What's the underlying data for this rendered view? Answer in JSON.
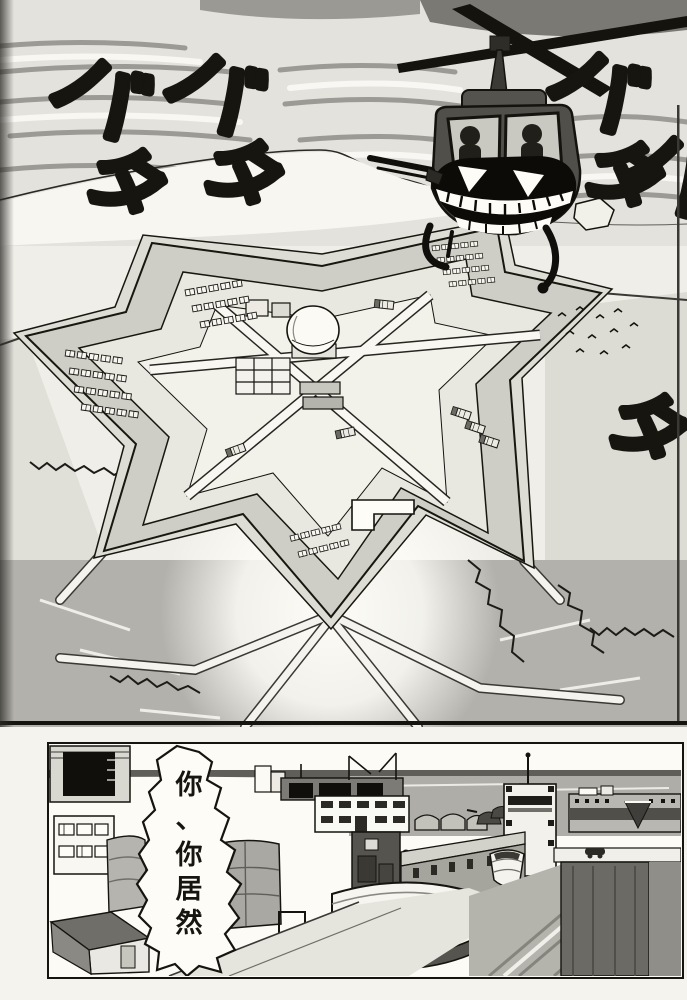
{
  "page": {
    "kind_label": "manga page",
    "colors": {
      "ink": "#15140f",
      "paper": "#f4f3ee",
      "sky_band": "#8f8e88",
      "field_grey": "#b2b1ab",
      "sea_grey": "#aeada7",
      "helicopter_body": "#514f49"
    }
  },
  "panel_top": {
    "sfx": {
      "groups": [
        {
          "ba": "バ",
          "ta": "タ"
        },
        {
          "ba": "バ",
          "ta": "タ"
        },
        {
          "ba": "バ",
          "ta": "タ"
        },
        {
          "ba": "バ",
          "ta": "タ"
        }
      ]
    }
  },
  "panel_bottom": {
    "speech_bubble": {
      "text": "你、你居然",
      "chars": [
        "你",
        "、",
        "你",
        "居",
        "然"
      ]
    }
  }
}
